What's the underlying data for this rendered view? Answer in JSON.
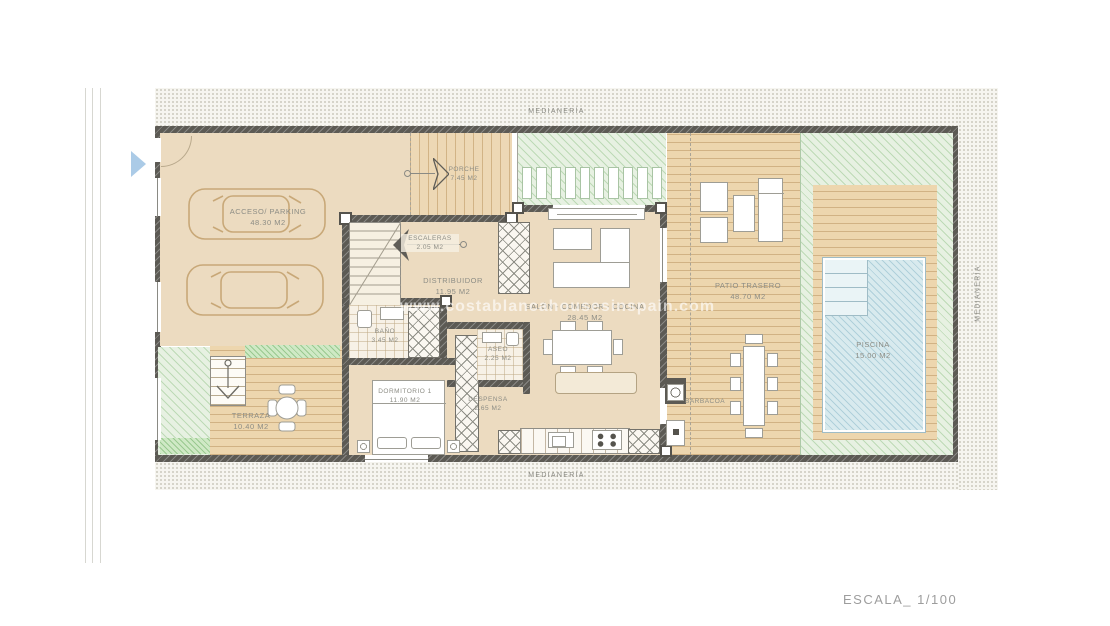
{
  "watermark": "www.costablancahousesinspain.com",
  "scale_label": "ESCALA_ 1/100",
  "boundary": {
    "top": "MEDIANERÍA",
    "bottom": "MEDIANERÍA",
    "right": "MEDIANERÍA"
  },
  "rooms": {
    "acceso": {
      "name": "ACCESO/ PARKING",
      "area": "48.30 m2"
    },
    "porche": {
      "name": "PORCHE",
      "area": "7.45 m2"
    },
    "escaleras": {
      "name": "ESCALERAS",
      "area": "2.05 m2"
    },
    "distribuidor": {
      "name": "DISTRIBUIDOR",
      "area": "11.95 m2"
    },
    "salon": {
      "name": "SALÓN - COMEDOR - COCINA",
      "area": "28.45 m2"
    },
    "bano": {
      "name": "BAÑO",
      "area": "3.45 m2"
    },
    "aseo": {
      "name": "ASEO",
      "area": "2.25 m2"
    },
    "dormitorio": {
      "name": "DORMITORIO 1",
      "area": "11.90 m2"
    },
    "despensa": {
      "name": "DESPENSA",
      "area": "2.65 m2"
    },
    "terraza": {
      "name": "TERRAZA",
      "area": "10.40 m2"
    },
    "patio": {
      "name": "PATIO TRASERO",
      "area": "48.70 m2"
    },
    "piscina": {
      "name": "PISCINA",
      "area": "15.00 m2"
    },
    "barbacoa": {
      "name": "BARBACOA"
    }
  },
  "colors": {
    "wall": "#5c5a54",
    "floor_beige": "#ecdbc0",
    "deck_wood": "#edd6ae",
    "garden_green": "#e7f1e2",
    "pool_blue": "#d8eaee",
    "location_arrow": "#abcbe7",
    "label_gray": "#8d8d85"
  }
}
